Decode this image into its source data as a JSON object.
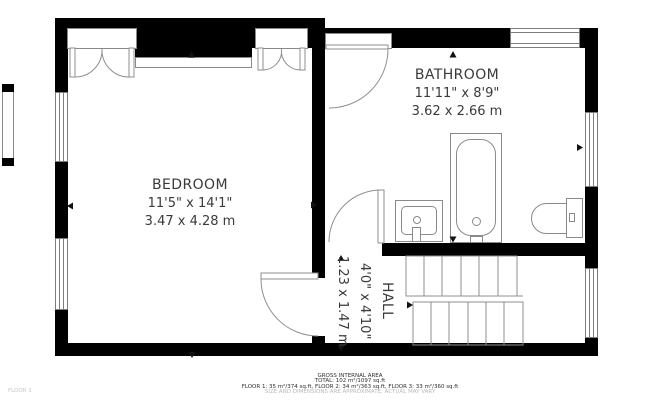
{
  "rooms": {
    "bedroom": {
      "name": "BEDROOM",
      "dims_ft": "11'5\" x 14'1\"",
      "dims_m": "3.47 x 4.28 m"
    },
    "bathroom": {
      "name": "BATHROOM",
      "dims_ft": "11'11\" x 8'9\"",
      "dims_m": "3.62 x 2.66 m"
    },
    "hall": {
      "name": "HALL",
      "dims_ft": "4'0\" x 4'10\"",
      "dims_m": "1.23 x 1.47 m"
    }
  },
  "footer": {
    "title": "GROSS INTERNAL AREA",
    "total": "TOTAL: 102 m²/1097 sq.ft",
    "floors": "FLOOR 1: 35 m²/374 sq.ft, FLOOR 2: 34 m²/363 sq.ft, FLOOR 3: 33 m²/360 sq.ft",
    "disclaimer": "SIZE AND DIMENSIONS ARE APPROXIMATE, ACTUAL MAY VARY"
  },
  "floor_label": "FLOOR 1",
  "colors": {
    "wall": "#000000",
    "line": "#8a8a8a",
    "text": "#3a3a3a",
    "muted": "#b9b9b9"
  }
}
